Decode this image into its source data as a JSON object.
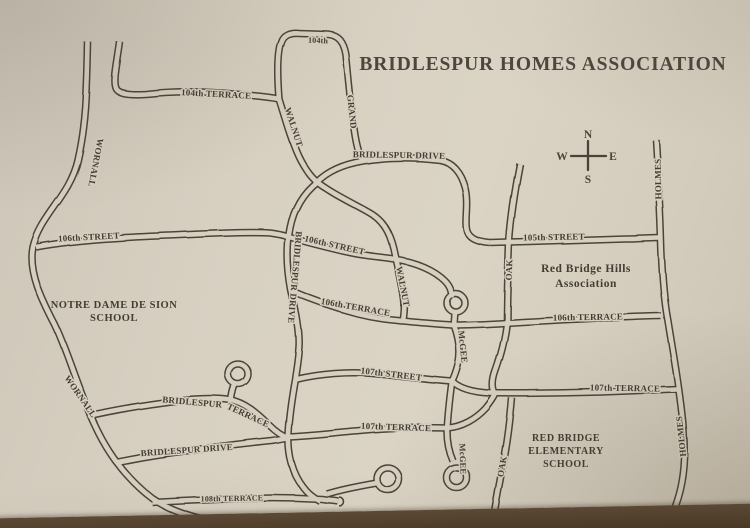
{
  "title": "BRIDLESPUR HOMES ASSOCIATION",
  "compass": {
    "n": "N",
    "s": "S",
    "e": "E",
    "w": "W"
  },
  "colors": {
    "ink": "#4a4439",
    "label_ink": "#433d33",
    "road_fill": "#d7d0c1",
    "paper_light": "#dbd4c5",
    "paper_dark": "#ccc4b4",
    "table": "#5d4a36"
  },
  "area_labels": [
    {
      "id": "notre-dame-school",
      "lines": [
        "NOTRE DAME DE SION",
        "SCHOOL"
      ],
      "x": 114,
      "y": 308,
      "lh": 13,
      "s": 10.5
    },
    {
      "id": "red-bridge-hills-association",
      "lines": [
        "Red Bridge Hills",
        "Association"
      ],
      "x": 586,
      "y": 272,
      "lh": 15,
      "s": 11.5
    },
    {
      "id": "red-bridge-elementary-school",
      "lines": [
        "RED BRIDGE",
        "ELEMENTARY",
        "SCHOOL"
      ],
      "x": 566,
      "y": 441,
      "lh": 13,
      "s": 10
    }
  ],
  "street_labels": [
    {
      "id": "wornall-north",
      "text": "WORNALL",
      "t": "translate(93,162) rotate(101)",
      "s": 9
    },
    {
      "id": "terrace-104",
      "text": "104th TERRACE",
      "t": "translate(216,97) rotate(3)",
      "s": 9
    },
    {
      "id": "street-104",
      "text": "104th",
      "t": "translate(318,43) rotate(2)",
      "s": 8
    },
    {
      "id": "walnut-north",
      "text": "WALNUT",
      "t": "translate(291,128) rotate(72)",
      "s": 9
    },
    {
      "id": "grand",
      "text": "GRAND",
      "t": "translate(349,112) rotate(84)",
      "s": 9
    },
    {
      "id": "bridlespur-drive-main",
      "text": "BRIDLESPUR DRIVE",
      "t": "translate(399,158) rotate(1)",
      "s": 9
    },
    {
      "id": "holmes-north",
      "text": "HOLMES",
      "t": "translate(661,179) rotate(-91)",
      "s": 9
    },
    {
      "id": "street-106-west",
      "text": "106th STREET",
      "t": "translate(89,240) rotate(-3)",
      "s": 9
    },
    {
      "id": "street-106-mid",
      "text": "106th STREET",
      "t": "translate(334,248) rotate(13)",
      "s": 9
    },
    {
      "id": "bridlespur-drive-vert",
      "text": "BRIDLESPUR DRIVE",
      "t": "translate(292,277) rotate(95)",
      "s": 9
    },
    {
      "id": "walnut-mid",
      "text": "WALNUT",
      "t": "translate(400,287) rotate(79)",
      "s": 9
    },
    {
      "id": "oak-north",
      "text": "OAK",
      "t": "translate(512,270) rotate(-88)",
      "s": 9
    },
    {
      "id": "street-105",
      "text": "105th STREET",
      "t": "translate(554,240) rotate(-1)",
      "s": 9
    },
    {
      "id": "terrace-106-mid",
      "text": "106th TERRACE",
      "t": "translate(355,310) rotate(10)",
      "s": 9
    },
    {
      "id": "terrace-106-east",
      "text": "106th TERRACE",
      "t": "translate(588,320) rotate(-1)",
      "s": 9
    },
    {
      "id": "mcgee-north",
      "text": "McGEE",
      "t": "translate(460,347) rotate(84)",
      "s": 9
    },
    {
      "id": "street-107",
      "text": "107th STREET",
      "t": "translate(391,377) rotate(7)",
      "s": 9
    },
    {
      "id": "terrace-107-east",
      "text": "107th TERRACE",
      "t": "translate(625,391) rotate(1)",
      "s": 9
    },
    {
      "id": "terrace-107-mid",
      "text": "107th TERRACE",
      "t": "translate(396,430) rotate(2)",
      "s": 9
    },
    {
      "id": "bridlespur-terrace-1",
      "text": "BRIDLESPUR",
      "t": "translate(192,405) rotate(5)",
      "s": 9
    },
    {
      "id": "bridlespur-terrace-2",
      "text": "TERRACE",
      "t": "translate(247,418) rotate(25)",
      "s": 9
    },
    {
      "id": "wornall-south",
      "text": "WORNALL",
      "t": "translate(78,398) rotate(55)",
      "s": 9
    },
    {
      "id": "bridlespur-drive-south",
      "text": "BRIDLESPUR DRIVE",
      "t": "translate(187,453) rotate(-4)",
      "s": 9
    },
    {
      "id": "terrace-108",
      "text": "108th TERRACE",
      "t": "translate(232,501) rotate(-1)",
      "s": 8
    },
    {
      "id": "mcgee-south",
      "text": "McGEE",
      "t": "translate(460,459) rotate(88)",
      "s": 8.5
    },
    {
      "id": "oak-south",
      "text": "OAK",
      "t": "translate(505,467) rotate(-80)",
      "s": 9
    },
    {
      "id": "holmes-south",
      "text": "HOLMES",
      "t": "translate(684,436) rotate(-96)",
      "s": 9
    }
  ],
  "roads": [
    {
      "id": "wornall",
      "d": "M 88,42 C 87,95 86,125 78,160 C 70,196 40,216 33,247 C 28,272 42,300 55,325 C 68,352 78,390 95,425 C 106,449 124,477 152,498 C 186,522 240,527 305,528"
    },
    {
      "id": "terrace-104",
      "d": "M 120,42 C 117,65 113,80 116,88 C 118,94 130,95 146,94 C 182,90 212,92 246,95 C 259,96 269,97 279,99"
    },
    {
      "id": "loop-104-grand",
      "d": "M 279,99 C 277,72 277,52 281,42 C 283,35 290,32 299,33 L 328,34 C 338,35 344,42 346,55 C 349,85 351,110 355,135 C 357,147 359,155 363,161"
    },
    {
      "id": "walnut",
      "d": "M 279,99 C 285,118 291,140 299,157 C 305,169 311,177 317,182 C 331,193 352,203 368,212 C 383,220 390,232 394,249 C 398,268 402,284 404,300 C 405,308 404,315 403,321"
    },
    {
      "id": "bridlespur-drive",
      "d": "M 490,243 C 480,242 470,240 467,231 C 464,222 469,204 465,188 C 461,172 452,162 440,160 C 415,157 385,157 363,161 C 345,164 329,170 317,182 C 303,193 294,208 290,228 C 286,248 287,268 291,290 C 296,312 300,332 299,347 C 298,362 296,371 295,379 C 292,396 289,414 288,434 C 287,454 292,473 303,487 C 308,494 314,498 320,501"
    },
    {
      "id": "street-106-west",
      "d": "M 36,247 C 80,239 130,237 180,235 C 220,233 255,232 270,233 C 277,234 284,235 288,237"
    },
    {
      "id": "street-106-mid",
      "d": "M 288,237 C 310,243 332,249 352,253 C 367,256 381,257 394,259"
    },
    {
      "id": "walnut-mcgee-connector",
      "d": "M 394,259 C 416,262 434,270 445,281 C 450,286 452,292 452,298"
    },
    {
      "id": "mcgee-north-bulb",
      "d": "M 447,303 A 9,9 0 1 0 465,303 A 9,9 0 1 0 447,303"
    },
    {
      "id": "mcgee-north-stub",
      "d": "M 455,312 L 454,326"
    },
    {
      "id": "terrace-106",
      "d": "M 291,291 C 312,300 335,308 358,314 C 378,319 392,320 403,321 C 422,323 438,324 452,325 C 470,325 490,324 506,323 C 540,321 575,319 605,318 C 630,317 648,316 661,316"
    },
    {
      "id": "mcgee",
      "d": "M 454,325 C 459,339 461,352 458,364 C 456,372 454,377 452,381 C 450,396 448,413 447,431 C 447,442 449,452 453,461"
    },
    {
      "id": "mcgee-south-bulb",
      "d": "M 447,478 A 10,10 0 1 0 467,478 A 10,10 0 1 0 447,478"
    },
    {
      "id": "street-107",
      "d": "M 295,379 C 320,373 348,371 372,373 C 398,375 422,379 452,381"
    },
    {
      "id": "terrace-107-east",
      "d": "M 452,381 C 459,388 471,392 489,393 C 525,394 562,393 602,392 C 632,391 656,390 677,389"
    },
    {
      "id": "terrace-107-mid",
      "d": "M 288,437 C 312,436 335,433 360,431 C 390,428 418,427 447,428 C 462,427 476,419 486,408 C 491,402 494,397 496,393"
    },
    {
      "id": "oak-north",
      "d": "M 520,164 C 515,190 511,215 509,242 C 508,270 507,296 507,322 C 505,342 500,358 495,372 C 492,381 492,387 494,392"
    },
    {
      "id": "oak-south",
      "d": "M 512,398 C 510,422 507,446 502,470 C 499,486 496,501 494,515"
    },
    {
      "id": "street-105",
      "d": "M 490,243 L 530,242 C 562,241 595,240 625,239 C 640,239 651,238 659,238"
    },
    {
      "id": "holmes",
      "d": "M 656,140 C 658,172 660,205 661,242 C 662,277 664,300 668,321 C 672,346 676,369 679,391 C 682,413 685,436 684,459 C 683,481 678,501 670,517"
    },
    {
      "id": "bridlespur-terrace",
      "d": "M 88,416 C 118,409 150,404 183,400 C 205,398 219,398 230,400 C 245,403 257,413 269,425 C 276,432 282,436 288,438"
    },
    {
      "id": "bridlespur-terrace-bulb-stub",
      "d": "M 231,399 C 232,393 233,388 235,384"
    },
    {
      "id": "bridlespur-terrace-bulb",
      "d": "M 228,374 A 10,10 0 1 0 248,374 A 10,10 0 1 0 228,374"
    },
    {
      "id": "bridlespur-drive-south",
      "d": "M 116,463 C 140,458 165,454 190,451 C 220,447 250,443 272,441 C 278,440 284,439 288,438"
    },
    {
      "id": "terrace-108",
      "d": "M 152,502 C 185,500 215,499 245,498 C 275,497 305,498 322,499 C 328,500 334,500 338,501"
    },
    {
      "id": "terrace-108-branch",
      "d": "M 327,494 C 340,490 354,487 377,483"
    },
    {
      "id": "terrace-108-bulb",
      "d": "M 377,479 A 11,11 0 1 0 399,479 A 11,11 0 1 0 377,479"
    },
    {
      "id": "terrace-108-end-cap",
      "d": "M 339,497 A 4.5,4.5 0 0 1 339,506",
      "thin": true
    }
  ]
}
